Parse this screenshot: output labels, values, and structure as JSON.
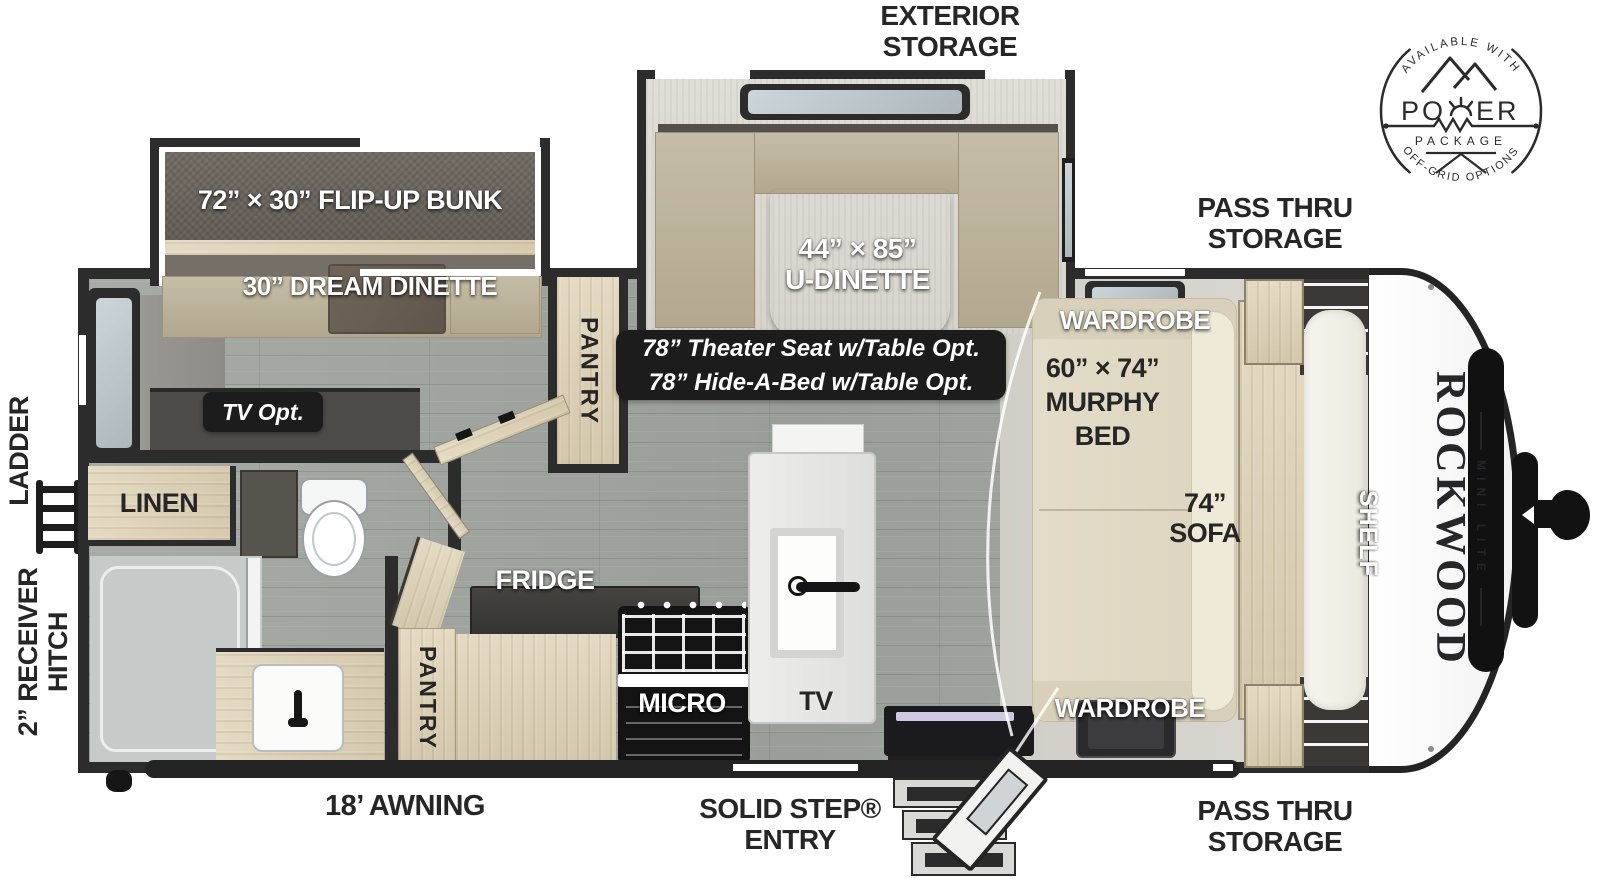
{
  "labels": {
    "exterior1": "EXTERIOR",
    "exterior2": "STORAGE",
    "passThruTop1": "PASS THRU",
    "passThruTop2": "STORAGE",
    "passThruBot1": "PASS THRU",
    "passThruBot2": "STORAGE",
    "ladder": "LADDER",
    "receiver1": "2” RECEIVER",
    "receiver2": "HITCH",
    "awning": "18’ AWNING",
    "solidStep1": "SOLID STEP®",
    "solidStep2": "ENTRY"
  },
  "rooms": {
    "bunk": "72” × 30” FLIP-UP BUNK",
    "dreamDinette": "30” DREAM DINETTE",
    "uDinetteSize": "44” × 85”",
    "uDinetteName": "U-DINETTE",
    "options1": "78” Theater Seat w/Table Opt.",
    "options2": "78” Hide-A-Bed w/Table Opt.",
    "tvOpt": "TV Opt.",
    "linen": "LINEN",
    "pantryTop": "PANTRY",
    "pantryBottom": "PANTRY",
    "fridge": "FRIDGE",
    "micro": "MICRO",
    "tv": "TV",
    "wardrobeTop": "WARDROBE",
    "wardrobeBottom": "WARDROBE",
    "murphySize": "60” × 74”",
    "murphy1": "MURPHY",
    "murphy2": "BED",
    "sofaSize": "74”",
    "sofaName": "SOFA",
    "shelf": "SHELF"
  },
  "brand": {
    "badgeTop": "AVAILABLE WITH",
    "badgeLeft": "PO",
    "badgeRight": "ER",
    "badgeSub": "PACKAGE",
    "badgeBottom": "OFF-GRID OPTIONS",
    "logoName": "ROCKWOOD",
    "logoSub": "MINI LITE"
  },
  "colors": {
    "wall": "#2c2c2c",
    "floor": "#a3a8a2",
    "wood": "#ddd2ba",
    "accent": "#1c1c1c"
  }
}
